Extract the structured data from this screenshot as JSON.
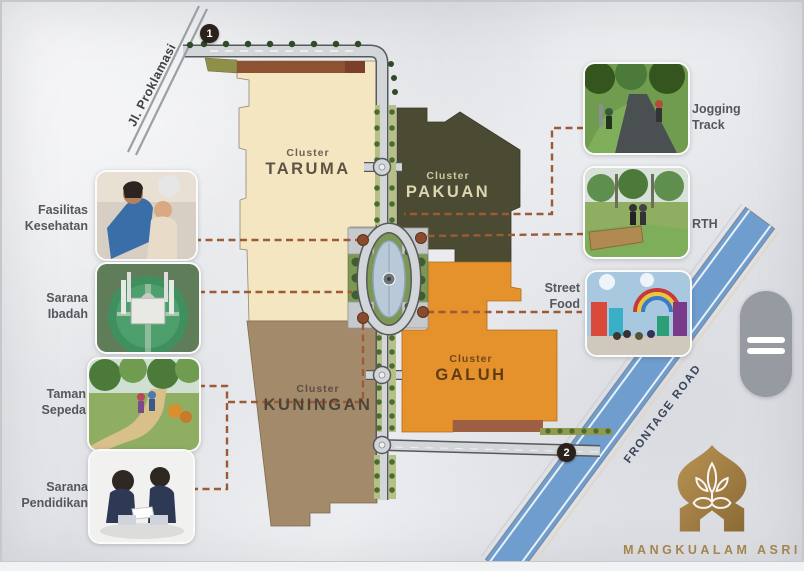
{
  "map": {
    "clusters": {
      "taruma": {
        "prefix": "Cluster",
        "name": "TARUMA"
      },
      "pakuan": {
        "prefix": "Cluster",
        "name": "PAKUAN"
      },
      "galuh": {
        "prefix": "Cluster",
        "name": "GALUH"
      },
      "kuningan": {
        "prefix": "Cluster",
        "name": "KUNINGAN"
      }
    },
    "roads": {
      "jl_proklamasi": "Jl. Proklamasi",
      "frontage_road": "FRONTAGE ROAD"
    },
    "markers": {
      "entrance_1": "1",
      "entrance_2": "2"
    }
  },
  "amenities": {
    "fasilitas_kesehatan": {
      "label": "Fasilitas Kesehatan"
    },
    "sarana_ibadah": {
      "label": "Sarana Ibadah"
    },
    "taman_sepeda": {
      "label": "Taman Sepeda"
    },
    "sarana_pendidikan": {
      "label": "Sarana Pendidikan"
    },
    "jogging_track": {
      "label": "Jogging Track"
    },
    "rth": {
      "label": "RTH"
    },
    "street_food": {
      "label": "Street Food"
    }
  },
  "brand": {
    "name": "MANGKUALAM ASRI"
  },
  "colors": {
    "cluster_taruma": "#f5e6c2",
    "cluster_pakuan": "#4b4a33",
    "cluster_galuh": "#e5912c",
    "cluster_kuningan": "#a38a6b",
    "commercial_strip": "#8d5231",
    "frontage_road": "#6f9dce",
    "connector_dash": "#9c5b35",
    "logo_gold": "#a5854e",
    "marker": "#2a211b"
  }
}
